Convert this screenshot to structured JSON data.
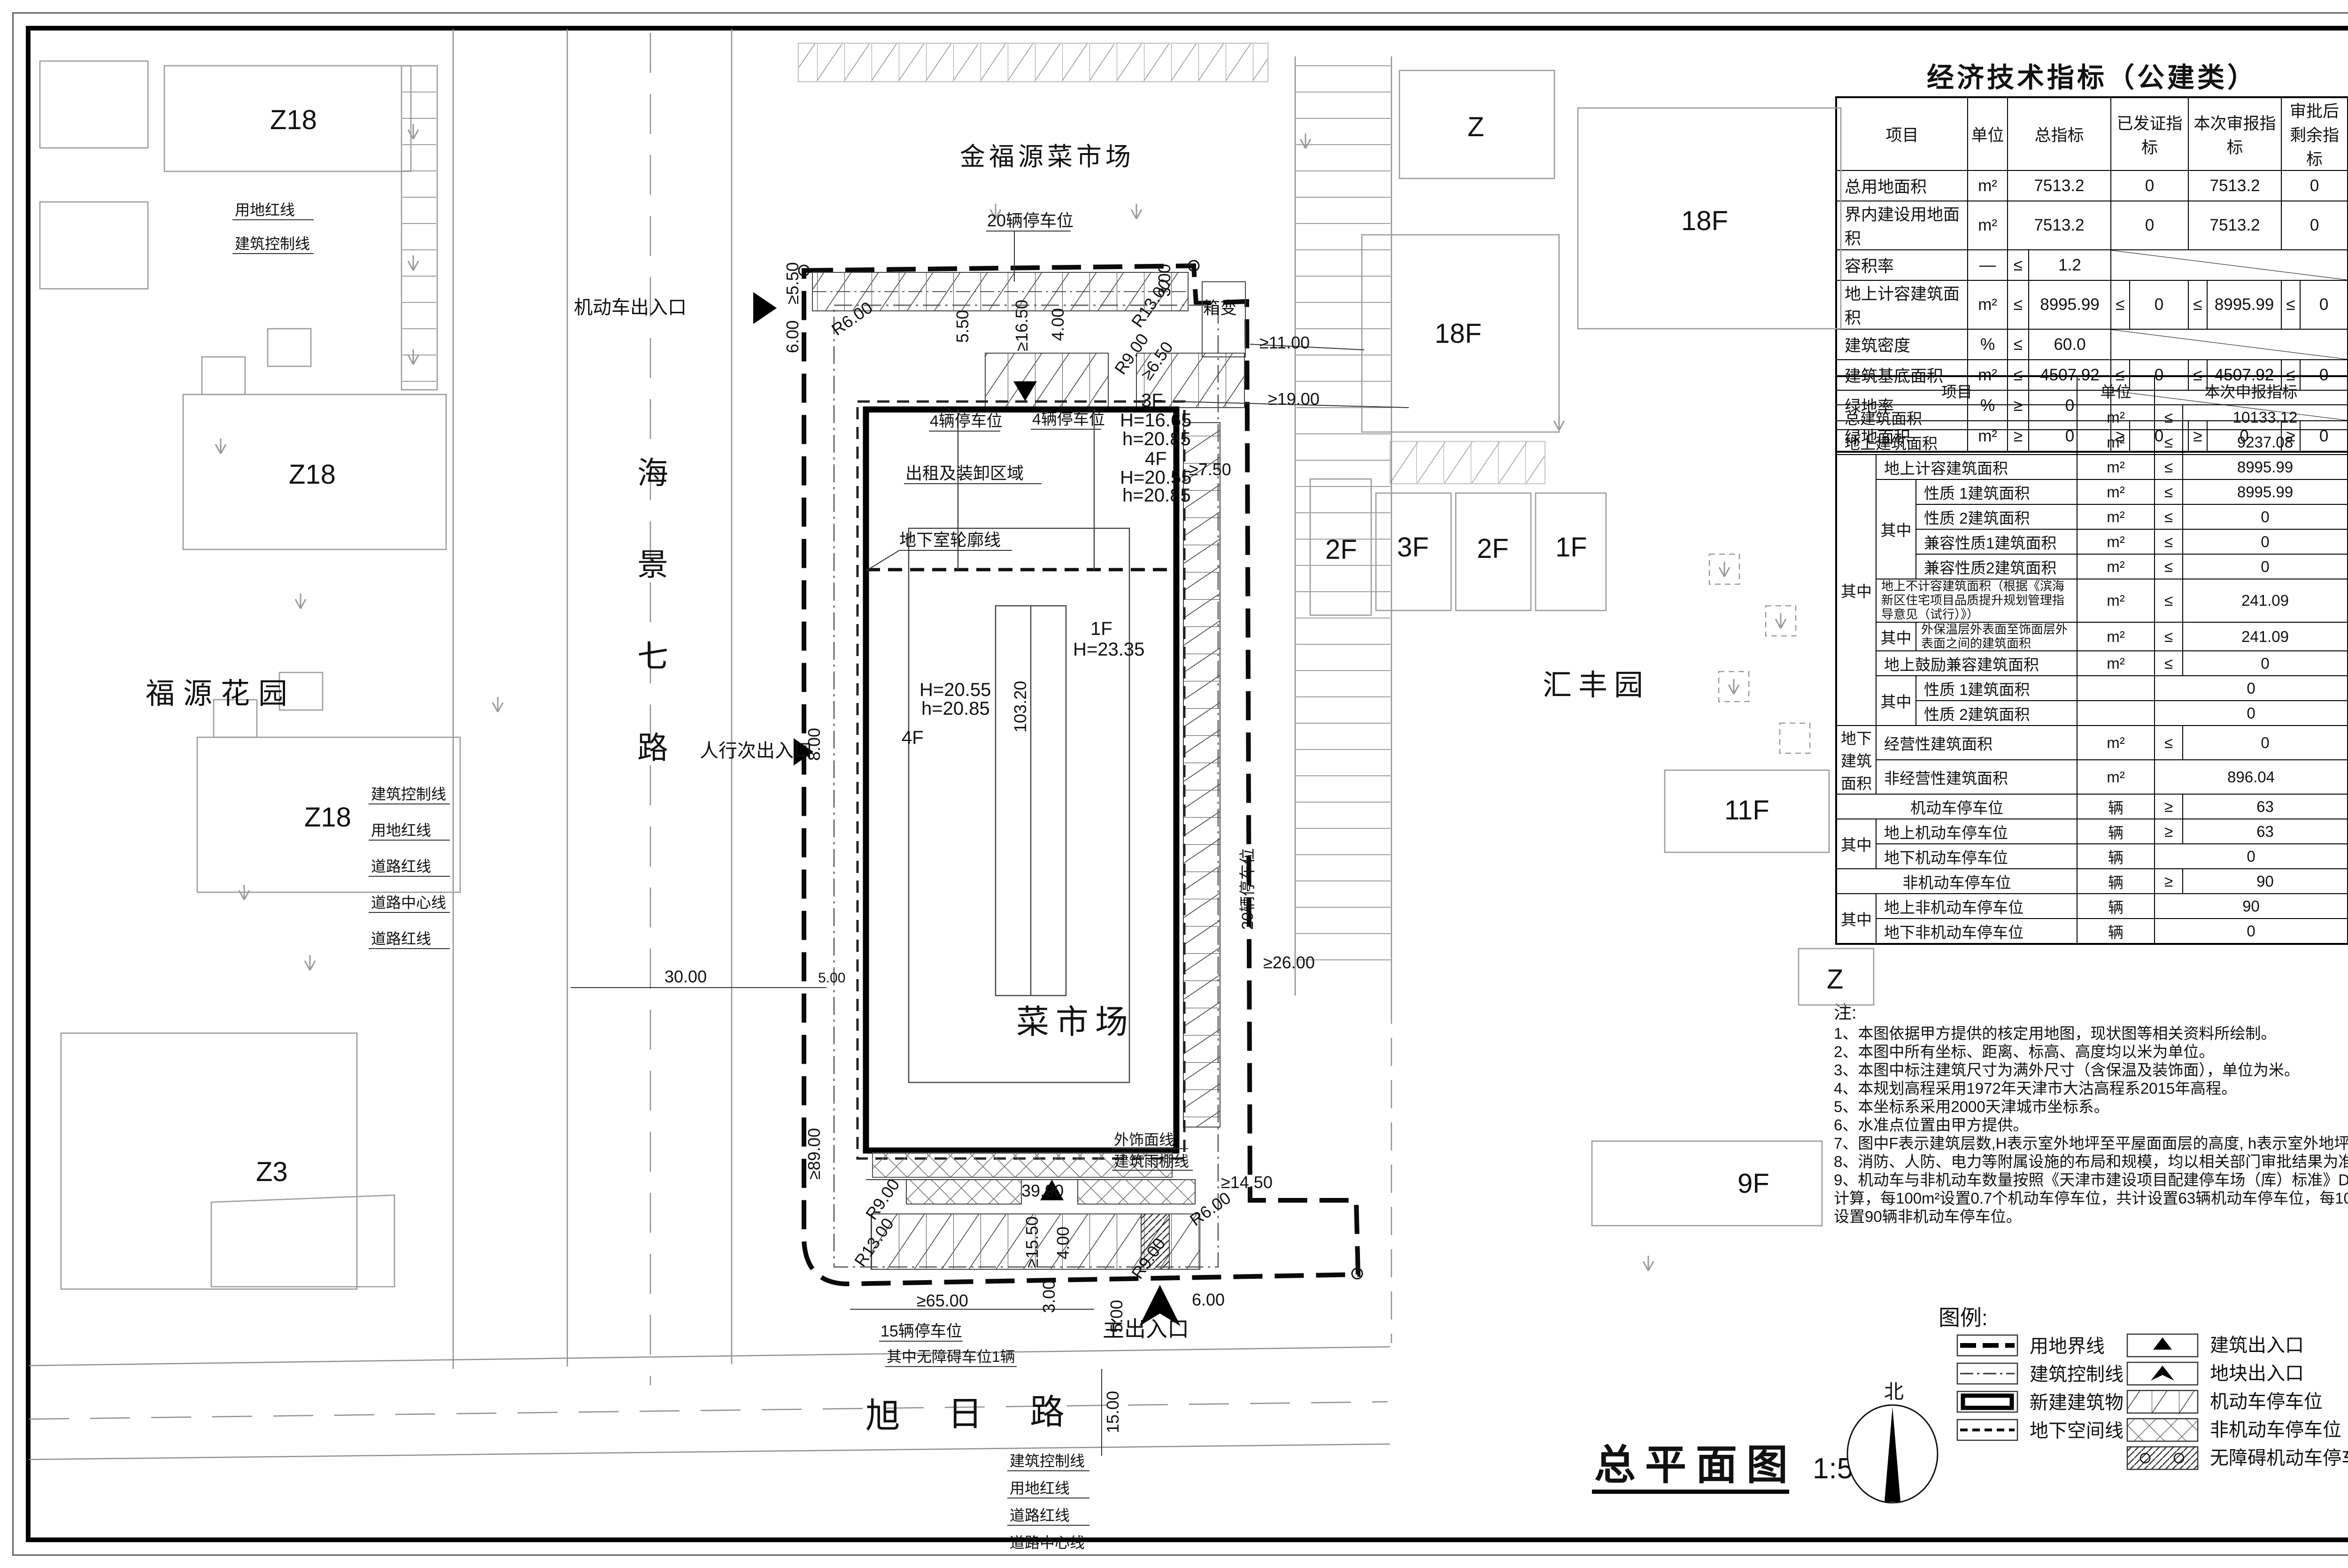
{
  "table1": {
    "title": "经济技术指标（公建类）",
    "headers": [
      "项目",
      "单位",
      "总指标",
      "已发证指标",
      "本次审报指标",
      "审批后剩余指标"
    ],
    "cmp_le": "≤",
    "cmp_ge": "≥",
    "rows": [
      {
        "name": "总用地面积",
        "unit": "m²",
        "total": "7513.2",
        "issued": "0",
        "current": "7513.2",
        "remain": "0"
      },
      {
        "name": "界内建设用地面积",
        "unit": "m²",
        "total": "7513.2",
        "issued": "0",
        "current": "7513.2",
        "remain": "0"
      },
      {
        "name": "容积率",
        "unit": "—",
        "cmp": "≤",
        "total": "1.2"
      },
      {
        "name": "地上计容建筑面积",
        "unit": "m²",
        "cmp": "≤",
        "total": "8995.99",
        "issued": "0",
        "current": "8995.99",
        "remain": "0"
      },
      {
        "name": "建筑密度",
        "unit": "%",
        "cmp": "≤",
        "total": "60.0"
      },
      {
        "name": "建筑基底面积",
        "unit": "m²",
        "cmp": "≤",
        "total": "4507.92",
        "issued": "0",
        "current": "4507.92",
        "remain": "0"
      },
      {
        "name": "绿地率",
        "unit": "%",
        "cmp": "≥",
        "total": "0"
      },
      {
        "name": "绿地面积",
        "unit": "m²",
        "cmp": "≥",
        "total": "0",
        "issued": "0",
        "current": "0",
        "remain": "0"
      }
    ]
  },
  "table2": {
    "headers": [
      "项目",
      "单位",
      "本次申报指标"
    ],
    "g": "其中",
    "g2": "地下建筑面积",
    "rows": [
      {
        "name": "总建筑面积",
        "unit": "m²",
        "cmp": "≤",
        "value": "10133.12"
      },
      {
        "name": "地上建筑面积",
        "unit": "m²",
        "cmp": "≤",
        "value": "9237.08"
      },
      {
        "name": "地上计容建筑面积",
        "unit": "m²",
        "cmp": "≤",
        "value": "8995.99"
      },
      {
        "name": "性质 1建筑面积",
        "unit": "m²",
        "cmp": "≤",
        "value": "8995.99"
      },
      {
        "name": "性质 2建筑面积",
        "unit": "m²",
        "cmp": "≤",
        "value": "0"
      },
      {
        "name": "兼容性质1建筑面积",
        "unit": "m²",
        "cmp": "≤",
        "value": "0"
      },
      {
        "name": "兼容性质2建筑面积",
        "unit": "m²",
        "cmp": "≤",
        "value": "0"
      },
      {
        "name": "地上不计容建筑面积（根据《滨海新区住宅项目品质提升规划管理指导意见（试行）》）",
        "unit": "m²",
        "cmp": "≤",
        "value": "241.09"
      },
      {
        "name": "外保温层外表面至饰面层外表面之间的建筑面积",
        "unit": "m²",
        "cmp": "≤",
        "value": "241.09"
      },
      {
        "name": "地上鼓励兼容建筑面积",
        "unit": "m²",
        "cmp": "≤",
        "value": "0"
      },
      {
        "name": "性质 1建筑面积",
        "unit": "",
        "cmp": "",
        "value": "0"
      },
      {
        "name": "性质 2建筑面积",
        "unit": "",
        "cmp": "",
        "value": "0"
      },
      {
        "name": "经营性建筑面积",
        "unit": "m²",
        "cmp": "≤",
        "value": "0"
      },
      {
        "name": "非经营性建筑面积",
        "unit": "m²",
        "cmp": "",
        "value": "896.04"
      },
      {
        "name": "机动车停车位",
        "unit": "辆",
        "cmp": "≥",
        "value": "63"
      },
      {
        "name": "地上机动车停车位",
        "unit": "辆",
        "cmp": "≥",
        "value": "63"
      },
      {
        "name": "地下机动车停车位",
        "unit": "辆",
        "cmp": "",
        "value": "0"
      },
      {
        "name": "非机动车停车位",
        "unit": "辆",
        "cmp": "≥",
        "value": "90"
      },
      {
        "name": "地上非机动车停车位",
        "unit": "辆",
        "cmp": "",
        "value": "90"
      },
      {
        "name": "地下非机动车停车位",
        "unit": "辆",
        "cmp": "",
        "value": "0"
      }
    ]
  },
  "notes": {
    "label": "注:",
    "lines": [
      "1、本图依据甲方提供的核定用地图，现状图等相关资料所绘制。",
      "2、本图中所有坐标、距离、标高、高度均以米为单位。",
      "3、本图中标注建筑尺寸为满外尺寸（含保温及装饰面），单位为米。",
      "4、本规划高程采用1972年天津市大沽高程系2015年高程。",
      "5、本坐标系采用2000天津城市坐标系。",
      "6、水准点位置由甲方提供。",
      "7、图中F表示建筑层数,H表示室外地坪至平屋面面层的高度, h表示室外地坪至女儿墙顶高度",
      "8、消防、人防、电力等附属设施的布局和规模，均以相关部门审批结果为准。",
      "9、机动车与非机动车数量按照《天津市建设项目配建停车场（库）标准》DB/T29-6-2018第4.0.1条规定",
      "计算，每100m²设置0.7个机动车停车位，共计设置63辆机动车停车位，每100m²设置1个非机动车停车位，共计",
      "设置90辆非机动车停车位。"
    ]
  },
  "legend": {
    "label": "图例:",
    "left": [
      "用地界线",
      "建筑控制线",
      "新建建筑物",
      "地下空间线"
    ],
    "right": [
      "建筑出入口",
      "地块出入口",
      "机动车停车位",
      "非机动车停车位",
      "无障碍机动车停车位"
    ]
  },
  "drawing_title": {
    "title": "总平面图",
    "scale": "1:500",
    "north": "北"
  },
  "plan": {
    "market": "菜市场",
    "neighbor_market": "金福源菜市场",
    "road_west": [
      "海",
      "景",
      "七",
      "路"
    ],
    "road_south": [
      "旭",
      "日",
      "路"
    ],
    "fuyuan": "福源花园",
    "huifeng": "汇丰园",
    "z18": "Z18",
    "z3": "Z3",
    "z": "Z",
    "f18": "18F",
    "f11": "11F",
    "f9": "9F",
    "f2": "2F",
    "f3": "3F",
    "f1": "1F",
    "entr_vehicle": "机动车出入口",
    "entr_ped": "人行次出入口",
    "entr_main": "主出入口",
    "p20": "20辆停车位",
    "p4": "4辆停车位",
    "p15": "15辆停车位",
    "p_acc": "其中无障碍车位1辆",
    "rental": "出租及装卸区域",
    "basement": "地下室轮廓线",
    "finish": "外饰面线",
    "canopy": "建筑雨棚线",
    "transformer": "箱变",
    "l_ctrl": "建筑控制线",
    "l_red": "用地红线",
    "l_road_red": "道路红线",
    "l_road_ctr": "道路中心线",
    "fl3": "3F",
    "fl3_h": "H=16.65",
    "fl3_hh": "h=20.85",
    "fl4": "4F",
    "fl4_h": "H=20.55",
    "fl4_hh": "h=20.85",
    "fl1": "1F",
    "fl1_h": "H=23.35",
    "dim_len": "103.20",
    "dim_w": "39.90",
    "d_550": "≥5.50",
    "d_600": "6.00",
    "d_550b": "5.50",
    "d_1650": "≥16.50",
    "d_400": "4.00",
    "d_r13": "R13.00",
    "d_r9": "R9.00",
    "d_650": "≥6.50",
    "d_300": "3.00",
    "d_1100": "≥11.00",
    "d_1900": "≥19.00",
    "d_750": "≥7.50",
    "d_2600": "≥26.00",
    "d_1450": "≥14.50",
    "d_r6": "R6.00",
    "d_1550": "≥15.50",
    "d_6500": "≥65.00",
    "d_500": "5.00",
    "d_1500": "15.00",
    "d_3000": "30.00",
    "d_800": "8.00",
    "d_8900": "≥89.00"
  },
  "titleblock": {
    "company": {
      "logo_top": "BU",
      "logo_bottom": "PD",
      "name": "天津滨海新区城市规划设计研究院有限公司",
      "name_en": "Tianjin Binhai New Area Urban Planning & Design  Research Institute Co.Ltd.",
      "credentials": [
        "设计资质编号A112004772",
        "建筑工程专业甲级",
        "风景园林工程专项乙级",
        "市政给水工程专业丙级",
        "市政排水工程专业丙级"
      ],
      "address1": "地址:天津市滨海新区塘沽中心北路",
      "address2": "阳光金地2-1-02号",
      "postcode": "邮编: 300451",
      "tel": "Tel ：022-65270325",
      "fax": "Fax : 022-65270365"
    },
    "circle_stamp": {
      "text": "天津滨海新区城市规划设计研究院有限公司",
      "number": "1201160491212",
      "star": "★"
    },
    "cooperator": {
      "label": "合作单位:",
      "label_en": "COOPERATOR:"
    },
    "stamp_sec": {
      "label": "出图章:",
      "label_en": "S T A M P :"
    },
    "reg_sec": {
      "label": "执业注册章:",
      "label_en": "S T A M P"
    },
    "remark_sec": {
      "label": "备  注:",
      "label_en": "REMARK:"
    },
    "stamp1": {
      "l1": "工程勘察设计出图专用章",
      "l2": "（有效期至：2028年12月22日）",
      "l3": "单位:天津滨海新区城市规划设计研究院有限公司",
      "l4": "行业:建筑行业(建筑工程)",
      "l5": "级别:甲级　证书编号:A112004772",
      "l6": "天津市住房和城乡建设委员会制"
    },
    "stamp2": {
      "title": "中华人民共和国一级注册建筑师",
      "name": "姓 名: 蔡 瑾",
      "reg_no": "注册号: 1200477-007",
      "valid": "有效期: 至2025年10月",
      "emblem": "✶"
    },
    "rev": {
      "rows": [
        "4",
        "3",
        "2",
        "1"
      ],
      "rev": "版次",
      "rev_en": "REV",
      "date": "发行日期",
      "date_en": "DATE ISSUED",
      "subject": "摘  要",
      "subject_en": "SUBJECT"
    },
    "func": {
      "label": "职  责",
      "label_en": "FUNCTION",
      "sig": "签  署",
      "sig_en": "SIGNATURE"
    },
    "roles": [
      {
        "cn": "项目负责人",
        "en": "PROJECT LEAD"
      },
      {
        "cn": "工程主持人",
        "en": "PROJECT MANAGER"
      },
      {
        "cn": "专业负责人",
        "en": "DISCIPLINE LEAD"
      },
      {
        "cn": "审  核",
        "en": "REVIEWED BY"
      },
      {
        "cn": "校  对",
        "en": "CHECKED BY"
      },
      {
        "cn": "设  计",
        "en": "DESIGNED BY"
      },
      {
        "cn": "制  图",
        "en": "DRAWN BY"
      }
    ],
    "phase": {
      "label": "设计阶段",
      "label_en": "PHASE",
      "options": [
        {
          "t": "方案设计"
        },
        {
          "t": "扩初设计"
        },
        {
          "t": "施工图设计"
        }
      ]
    },
    "discipline": {
      "label": "专  业",
      "label_en": "DISCIPLINE",
      "options": [
        {
          "t": "规  划"
        },
        {
          "t": "建  筑"
        },
        {
          "t": "结  构"
        },
        {
          "t": "给排水"
        },
        {
          "t": "暖  通"
        },
        {
          "t": "强  电"
        },
        {
          "t": "弱  电"
        },
        {
          "t": "装  饰"
        },
        {
          "t": "景  观"
        }
      ]
    },
    "project": {
      "label": "工程名称",
      "label_en": "PROJECT",
      "value": "新建乐乐菜市场项目"
    },
    "subitem": {
      "label": "分项名称",
      "label_en": "SUBITEM",
      "value": ""
    },
    "title": {
      "label": "图  名",
      "label_en": "TITLE",
      "value": "总平面图"
    },
    "cno": {
      "label": "工  号",
      "label_en": "CONSTRUCTION N0.",
      "value": "JZXH-2419"
    },
    "pno": {
      "label": "分  号",
      "label_en": "PART  N0.",
      "value": ""
    },
    "dno": {
      "label": "图  号",
      "label_en": "DRAWING N0.",
      "value": "",
      "scale_label": "比例",
      "scale_en": "SCALE",
      "scale": "1:500"
    }
  }
}
